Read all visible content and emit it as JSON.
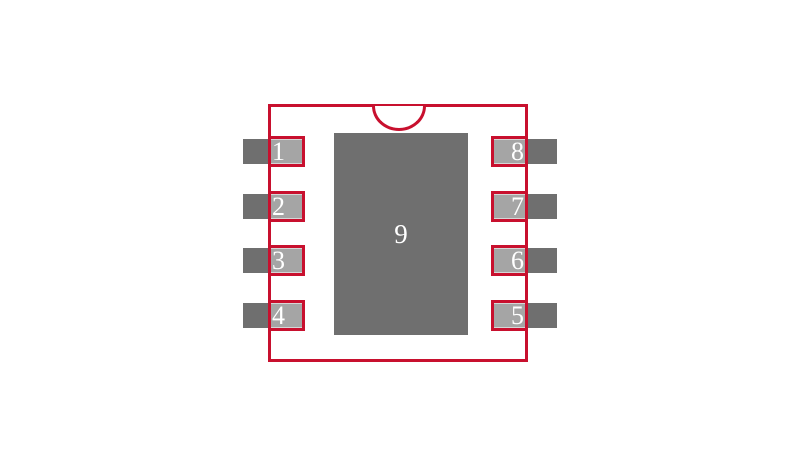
{
  "diagram": {
    "kind": "component-footprint-land-pattern",
    "left_pins": [
      {
        "number": "1"
      },
      {
        "number": "2"
      },
      {
        "number": "3"
      },
      {
        "number": "4"
      }
    ],
    "right_pins": [
      {
        "number": "8"
      },
      {
        "number": "7"
      },
      {
        "number": "6"
      },
      {
        "number": "5"
      }
    ],
    "thermal_pad": {
      "number": "9"
    },
    "pin1_indicator": "semicircle-notch-icon",
    "colors": {
      "outline_red": "#c8102e",
      "lead_dark_gray": "#6f6f6f",
      "pad_light_gray": "#a5a5a5",
      "thermal_pad_gray": "#6f6f6f",
      "number_text": "#ffffff",
      "background": "#ffffff"
    }
  }
}
